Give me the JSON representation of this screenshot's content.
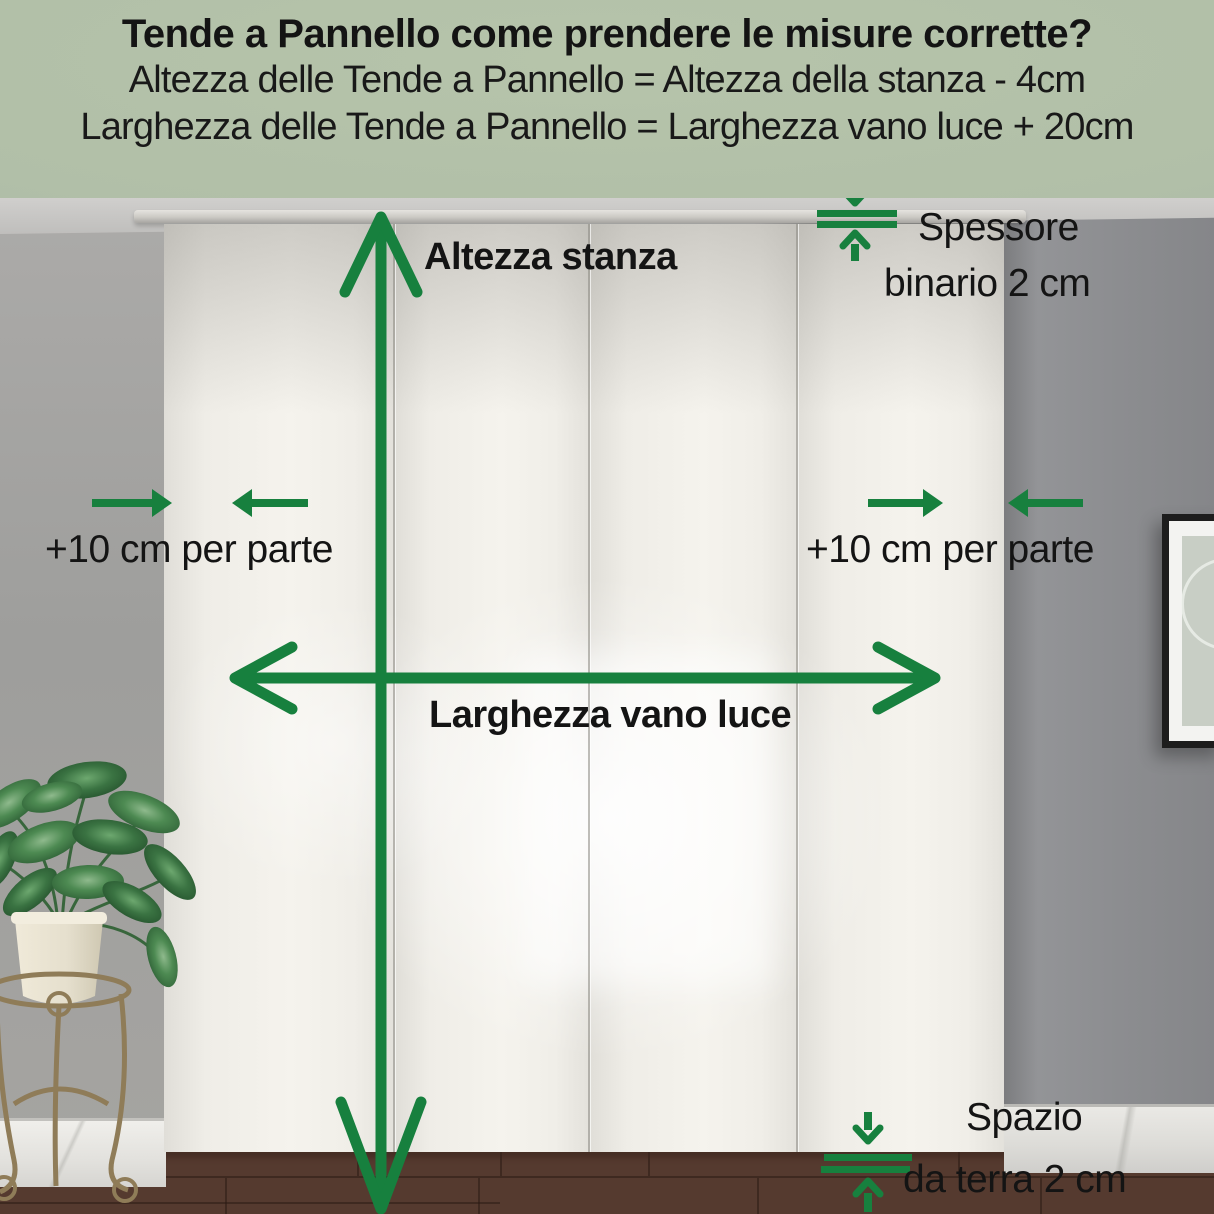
{
  "header": {
    "title": "Tende a Pannello come prendere le misure corrette?",
    "formula_height": "Altezza delle Tende a Pannello = Altezza della stanza - 4cm",
    "formula_width": "Larghezza delle Tende a Pannello = Larghezza vano luce + 20cm"
  },
  "labels": {
    "room_height": "Altezza stanza",
    "track_thickness_line1": "Spessore",
    "track_thickness_line2": "binario 2 cm",
    "side_allowance_left": "+10 cm per parte",
    "side_allowance_right": "+10 cm per parte",
    "opening_width": "Larghezza vano luce",
    "floor_gap_line1": "Spazio",
    "floor_gap_line2": "da terra 2 cm"
  },
  "colors": {
    "accent_green": "#17803E",
    "header_background": "#B1BFA8",
    "text_dark": "#141414"
  }
}
